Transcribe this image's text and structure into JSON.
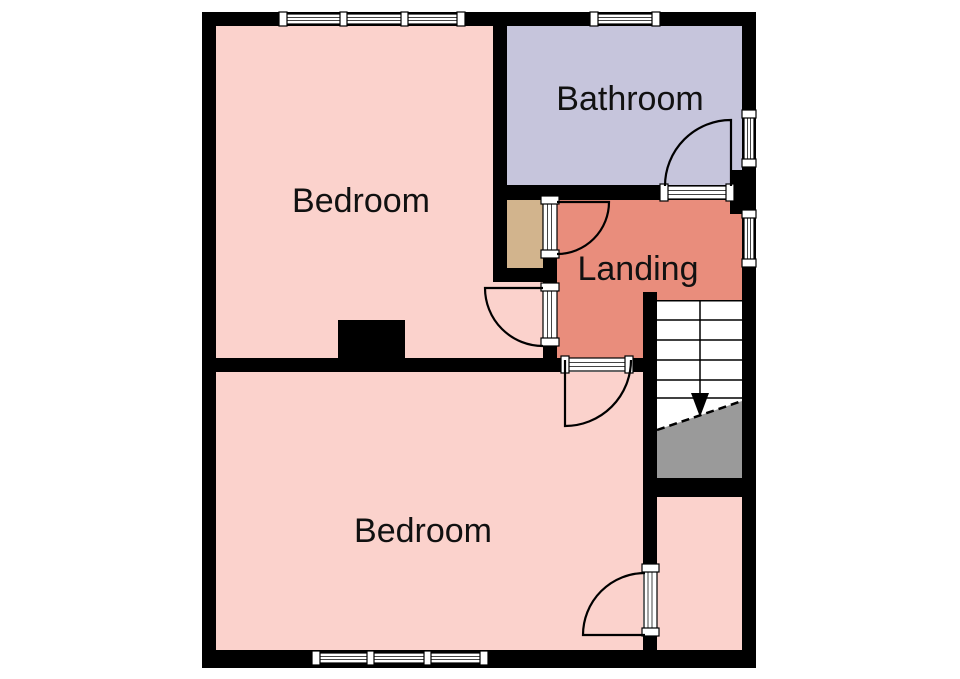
{
  "floorplan": {
    "background": "#ffffff",
    "wall_color": "#000000",
    "label_color": "#111111",
    "rooms": [
      {
        "id": "bedroom-front",
        "label": "Bedroom",
        "color": "#fbd2cc"
      },
      {
        "id": "bathroom",
        "label": "Bathroom",
        "color": "#c6c5dc"
      },
      {
        "id": "landing",
        "label": "Landing",
        "color": "#e98d7c"
      },
      {
        "id": "bedroom-back",
        "label": "Bedroom",
        "color": "#fbd2cc"
      },
      {
        "id": "cupboard",
        "label": "",
        "color": "#d2b48d"
      },
      {
        "id": "boxroom",
        "label": "",
        "color": "#fbd2cc"
      }
    ],
    "stairs": {
      "icon": "down-arrow",
      "tread_color": "#ffffff",
      "under_color": "#9a9a9a",
      "tread_lines": 5
    },
    "window_count": 5,
    "door_count": 5
  }
}
